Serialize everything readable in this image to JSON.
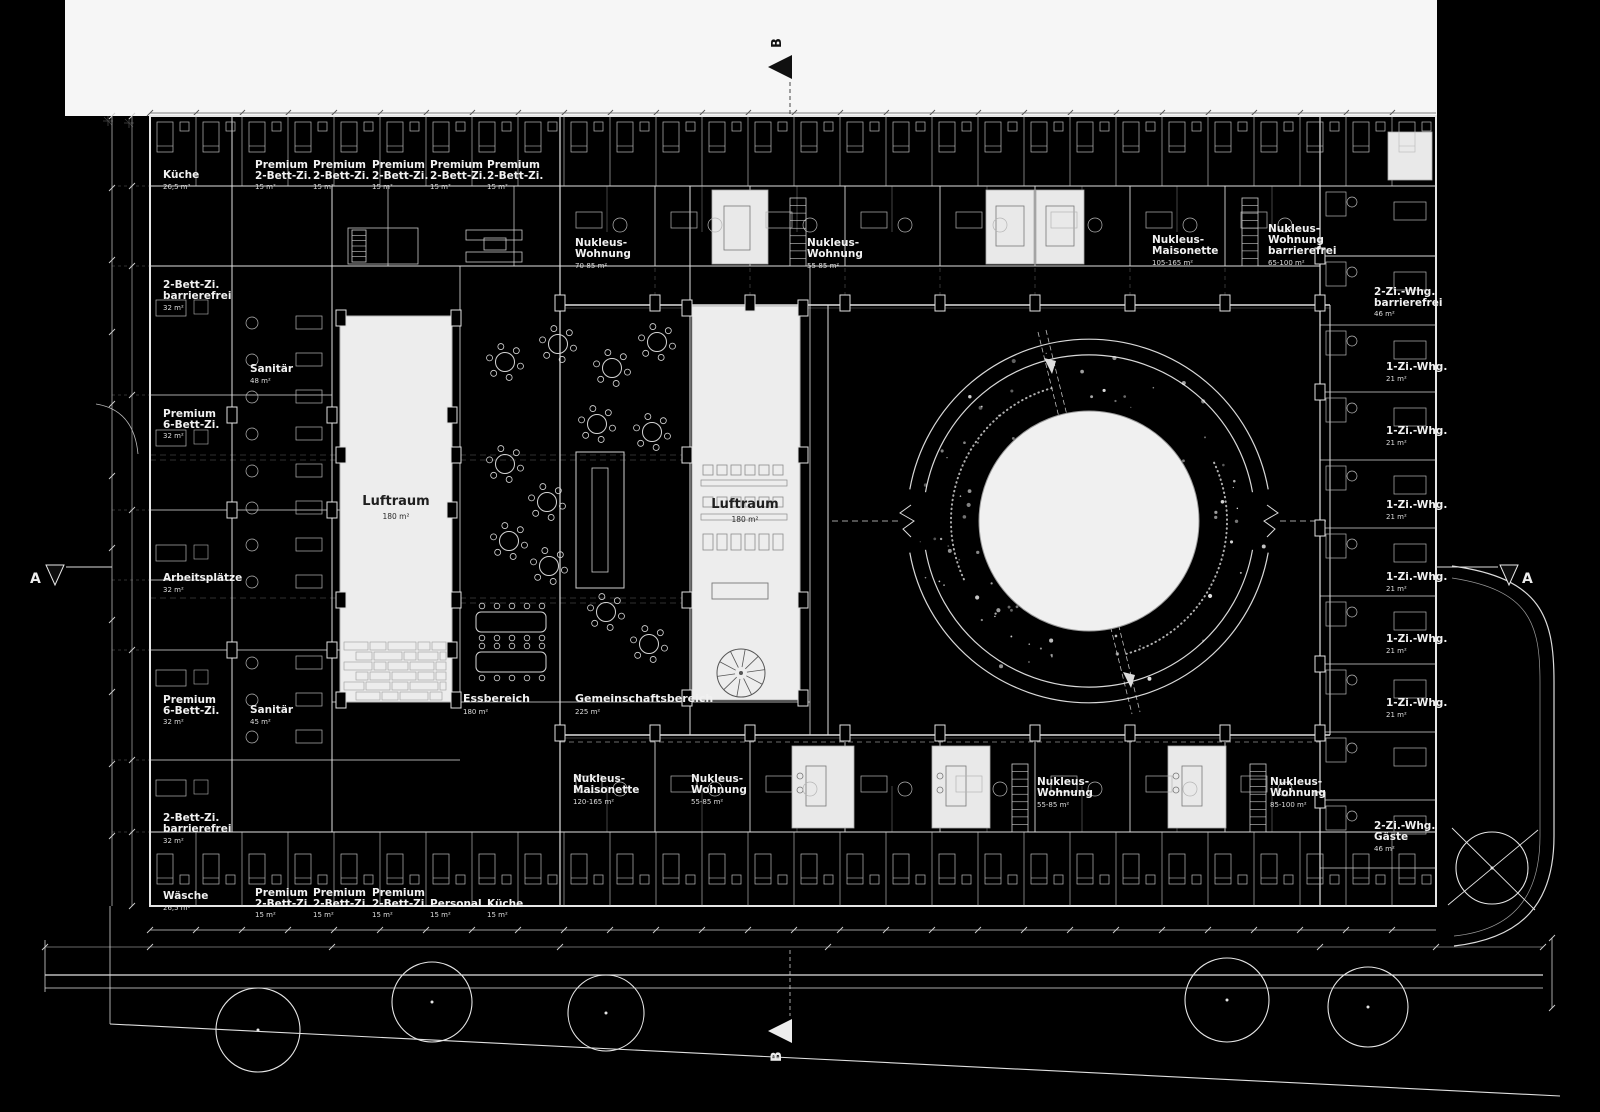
{
  "plan": {
    "section_markers": {
      "a": "A",
      "b": "B"
    },
    "voids": {
      "luftraum": {
        "name": "Luftraum",
        "area": "180 m²"
      }
    },
    "common_areas": {
      "essbereich": {
        "name": "Essbereich",
        "area": "180 m²"
      },
      "gemeinschaftsbereich": {
        "name": "Gemeinschaftsbereich",
        "area": "225 m²"
      }
    },
    "rooms": {
      "premium_2bett": {
        "l1": "Premium",
        "l2": "2-Bett-Zi.",
        "area": "15 m²"
      },
      "kueche_gross": {
        "l1": "Küche",
        "area": "26,5 m²"
      },
      "kueche_klein": {
        "l1": "Küche",
        "area": "15 m²"
      },
      "personal": {
        "l1": "Personal",
        "area": "15 m²"
      },
      "waesche": {
        "l1": "Wäsche",
        "area": "26,5 m²"
      },
      "zweibett_bf": {
        "l1": "2-Bett-Zi.",
        "l2": "barrierefrei",
        "area": "32 m²"
      },
      "premium_6bett": {
        "l1": "Premium",
        "l2": "6-Bett-Zi.",
        "area": "32 m²"
      },
      "arbeitsplaetze": {
        "l1": "Arbeitsplätze",
        "area": "32 m²"
      },
      "sanitaer_48": {
        "l1": "Sanitär",
        "area": "48 m²"
      },
      "sanitaer_45": {
        "l1": "Sanitär",
        "area": "45 m²"
      },
      "nukleus_wohnung_70_85": {
        "l1": "Nukleus-",
        "l2": "Wohnung",
        "area": "70-85 m²"
      },
      "nukleus_wohnung_55_85": {
        "l1": "Nukleus-",
        "l2": "Wohnung",
        "area": "55-85 m²"
      },
      "nukleus_wohnung_85_100": {
        "l1": "Nukleus-",
        "l2": "Wohnung",
        "area": "85-100 m²"
      },
      "nukleus_wohnung_bf": {
        "l1": "Nukleus-",
        "l2": "Wohnung",
        "l3": "barrierefrei",
        "area": "65-100 m²"
      },
      "nukleus_maisonette_105": {
        "l1": "Nukleus-",
        "l2": "Maisonette",
        "area": "105-165 m²"
      },
      "nukleus_maisonette_120": {
        "l1": "Nukleus-",
        "l2": "Maisonette",
        "area": "120-165 m²"
      },
      "whg_2zi_bf": {
        "l1": "2-Zi.-Whg.",
        "l2": "barrierefrei",
        "area": "46 m²"
      },
      "whg_1zi": {
        "l1": "1-Zi.-Whg.",
        "area": "21 m²"
      },
      "whg_2zi_gaeste": {
        "l1": "2-Zi.-Whg.",
        "l2": "Gäste",
        "area": "46 m²"
      }
    }
  }
}
